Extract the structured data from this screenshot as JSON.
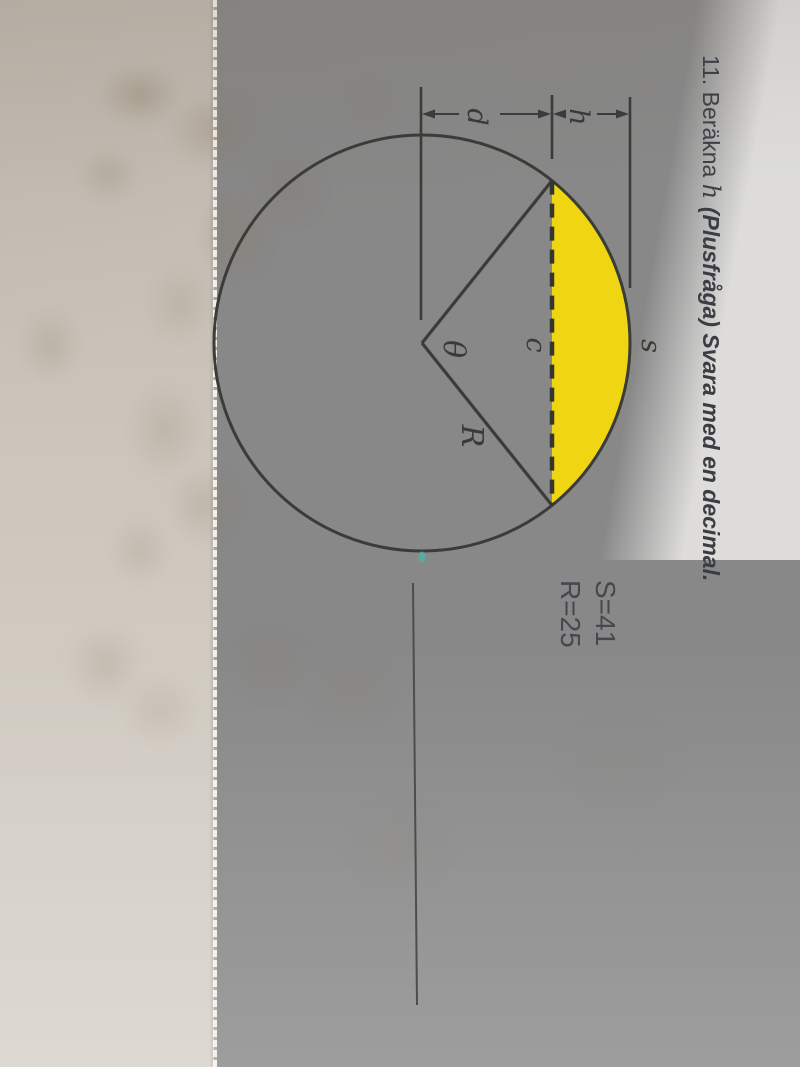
{
  "problem": {
    "number": "11. ",
    "verb": "Beräkna ",
    "variable": "h ",
    "rest": "(Plusfråga) Svara med en decimal."
  },
  "given": {
    "arc_value": "S=41",
    "radius_value": "R=25"
  },
  "diagram_labels": {
    "arc": "s",
    "segment_height": "h",
    "center_distance": "d",
    "chord": "c",
    "angle": "θ",
    "radius": "R"
  },
  "colors": {
    "highlight_yellow": "#f0d513",
    "ink": "#3b3b37",
    "teal_mark": "#4fb3aa",
    "paper": "#e4e0da",
    "margin_surface": "#c9c2b8"
  }
}
